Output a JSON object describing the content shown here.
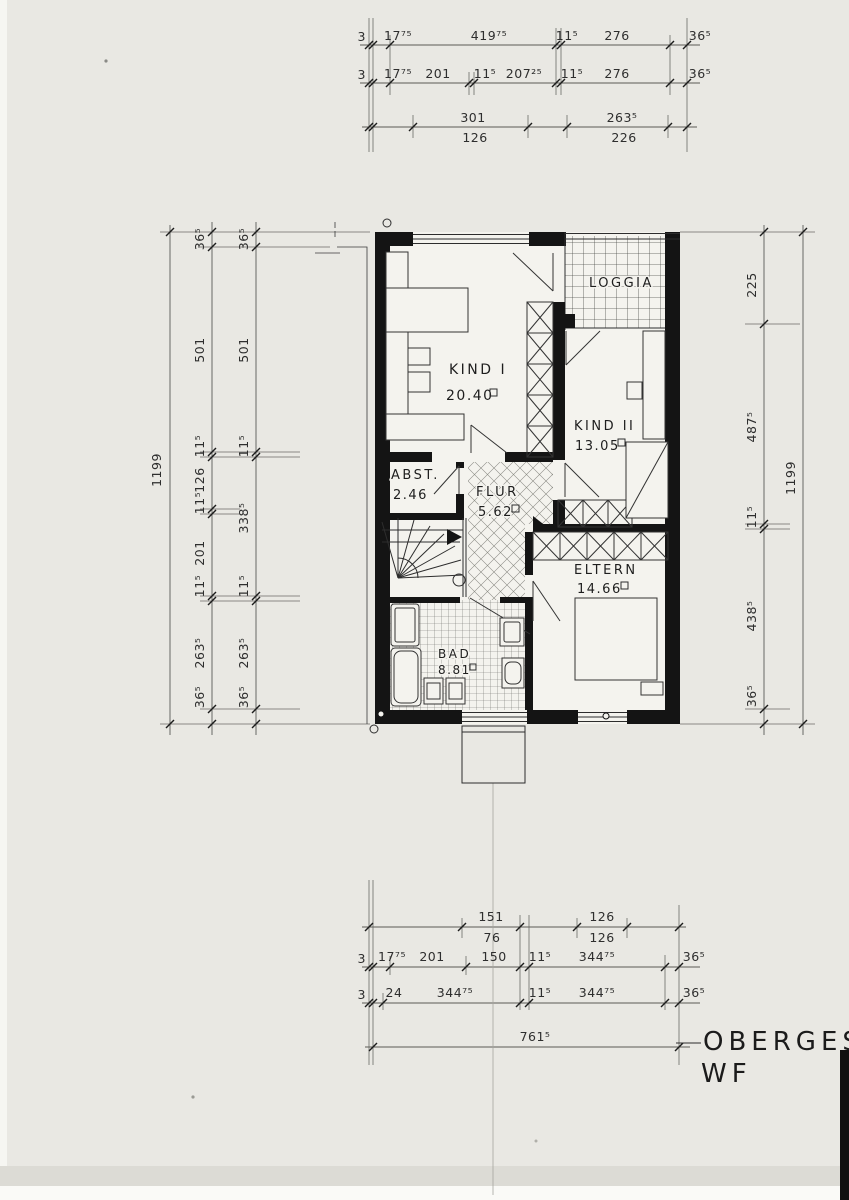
{
  "sheet": {
    "title_line1": "OBERGESC",
    "title_line2": "WF"
  },
  "rooms": {
    "loggia": {
      "name": "LOGGIA"
    },
    "kind1": {
      "name": "KIND I",
      "area": "20.40"
    },
    "kind2": {
      "name": "KIND II",
      "area": "13.05"
    },
    "abst": {
      "name": "ABST.",
      "area": "2.46"
    },
    "flur": {
      "name": "FLUR",
      "area": "5.62"
    },
    "eltern": {
      "name": "ELTERN",
      "area": "14.66"
    },
    "bad": {
      "name": "BAD",
      "area": "8.81"
    }
  },
  "dims": {
    "top": {
      "row1": [
        "3",
        "17⁷⁵",
        "419⁷⁵",
        "11⁵",
        "276",
        "36⁵"
      ],
      "row2": [
        "3",
        "17⁷⁵",
        "201",
        "11⁵",
        "207²⁵",
        "11⁵",
        "276",
        "36⁵"
      ],
      "row3_above": [
        "301",
        "263⁵"
      ],
      "row3_below": [
        "126",
        "226"
      ]
    },
    "bottom": {
      "row1_above": [
        "151",
        "126"
      ],
      "row1_below": [
        "76",
        "126"
      ],
      "row2": [
        "3",
        "17⁷⁵",
        "201",
        "150",
        "11⁵",
        "344⁷⁵",
        "36⁵"
      ],
      "row3": [
        "3",
        "24",
        "344⁷⁵",
        "11⁵",
        "344⁷⁵",
        "36⁵"
      ],
      "total": "761⁵"
    },
    "left": {
      "overall": "1199",
      "chain_inner": [
        "36⁵",
        "501",
        "11⁵",
        "126",
        "11⁵",
        "201",
        "11⁵",
        "263⁵",
        "36⁵"
      ],
      "chain_plan": [
        "36⁵",
        "501",
        "11⁵",
        "338⁵",
        "11⁵",
        "263⁵",
        "36⁵"
      ]
    },
    "right": {
      "overall": "1199",
      "chain": [
        "225",
        "487⁵",
        "11⁵",
        "438⁵",
        "36⁵"
      ]
    }
  }
}
